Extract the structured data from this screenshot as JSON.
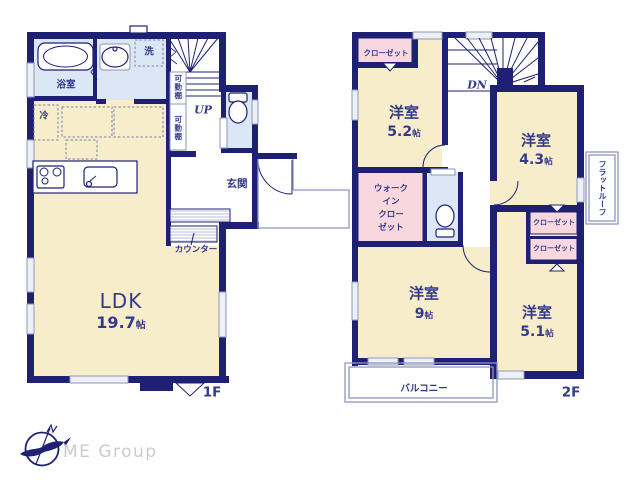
{
  "f1": {
    "label": "1F",
    "ldk": {
      "name": "LDK",
      "size": "19.7",
      "unit": "帖"
    },
    "bath": "浴室",
    "laundry": "洗",
    "fridge": "冷",
    "shelf1": "可動棚",
    "shelf2": "可動棚",
    "up": "UP",
    "entrance": "玄関",
    "counter": "カウンター"
  },
  "f2": {
    "label": "2F",
    "dn": "DN",
    "bed52": {
      "name": "洋室",
      "size": "5.2",
      "unit": "帖"
    },
    "bed43": {
      "name": "洋室",
      "size": "4.3",
      "unit": "帖"
    },
    "bed9": {
      "name": "洋室",
      "size": "9",
      "unit": "帖"
    },
    "bed51": {
      "name": "洋室",
      "size": "5.1",
      "unit": "帖"
    },
    "closet_nw": "クローゼット",
    "closet_a": "クローゼット",
    "closet_b": "クローゼット",
    "wic": {
      "l1": "ウォーク",
      "l2": "イン",
      "l3": "クロー",
      "l4": "ゼット"
    },
    "balcony": "バルコニー",
    "flat_roof": "フラットルーフ"
  },
  "footer": {
    "brand": "ME Group"
  },
  "colors": {
    "wall": "#1e2173",
    "text": "#333a8c",
    "cream": "#f8edcb",
    "blue": "#dbe7f4",
    "pink": "#f8d8de",
    "outline": "#8e96be",
    "window": "#eef0f7",
    "hatch": "#b9bedb",
    "brand": "#cccccc"
  }
}
